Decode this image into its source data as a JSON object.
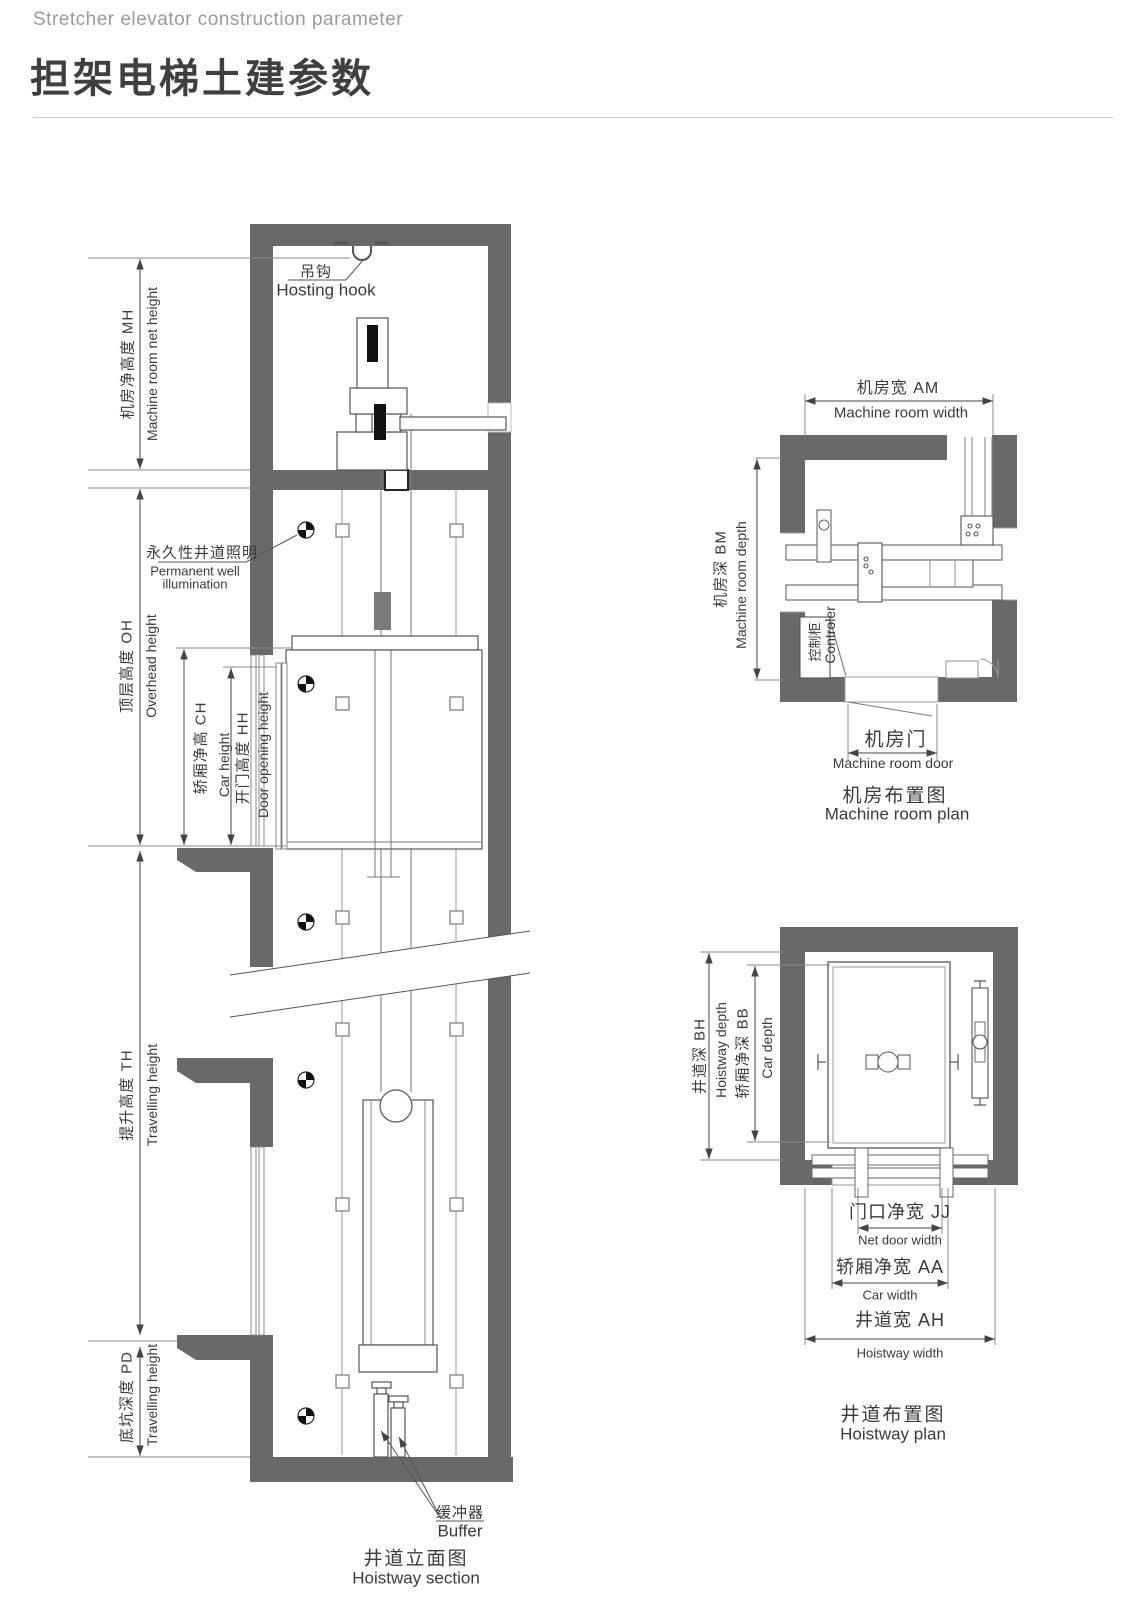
{
  "header": {
    "subtitle": "Stretcher elevator construction parameter",
    "title": "担架电梯土建参数"
  },
  "section": {
    "caption_cn": "井道立面图",
    "caption_en": "Hoistway section",
    "hook_cn": "吊钩",
    "hook_en": "Hosting hook",
    "illum_cn": "永久性井道照明",
    "illum_en1": "Permanent well",
    "illum_en2": "illumination",
    "buffer_cn": "缓冲器",
    "buffer_en": "Buffer",
    "mh_cn": "机房净高度 MH",
    "mh_en": "Machine room net height",
    "oh_cn": "顶层高度 OH",
    "oh_en": "Overhead height",
    "ch_cn": "轿厢净高 CH",
    "ch_en": "Car height",
    "hh_cn": "开门高度 HH",
    "hh_en": "Door opening height",
    "th_cn": "提升高度 TH",
    "th_en": "Travelling height",
    "pd_cn": "底坑深度 PD",
    "pd_en": "Travelling height"
  },
  "machine_room": {
    "caption_cn": "机房布置图",
    "caption_en": "Machine room plan",
    "am_cn": "机房宽 AM",
    "am_en": "Machine room width",
    "bm_cn": "机房深 BM",
    "bm_en": "Machine room depth",
    "door_cn": "机房门",
    "door_en": "Machine room door",
    "controller_cn": "控制柜",
    "controller_en": "Controler"
  },
  "hoistway": {
    "caption_cn": "井道布置图",
    "caption_en": "Hoistway plan",
    "bh_cn": "井道深 BH",
    "bh_en": "Hoistway depth",
    "bb_cn": "轿厢净深 BB",
    "bb_en": "Car depth",
    "jj_cn": "门口净宽 JJ",
    "jj_en": "Net door width",
    "aa_cn": "轿厢净宽 AA",
    "aa_en": "Car width",
    "ah_cn": "井道宽 AH",
    "ah_en": "Hoistway width"
  },
  "colors": {
    "wall": "#696969",
    "line": "#4a4a4a",
    "text": "#3a3a3a",
    "subtitle": "#9a9a9a"
  }
}
